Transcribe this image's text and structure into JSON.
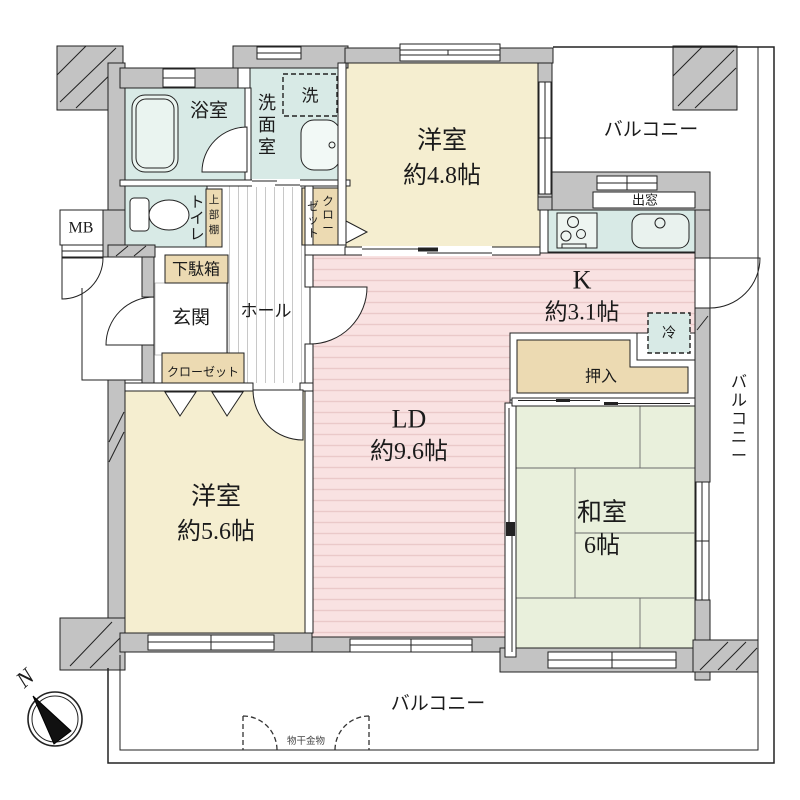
{
  "plan": {
    "compass": {
      "north": "N"
    },
    "balconies": {
      "top": "バルコニー",
      "right": "バルコニー",
      "bottom": "バルコニー",
      "laundry_fitting": "物干金物"
    },
    "rooms": {
      "western1": {
        "name": "洋室",
        "area": "約4.8帖"
      },
      "western2": {
        "name": "洋室",
        "area": "約5.6帖"
      },
      "living_dining": {
        "name": "LD",
        "area": "約9.6帖"
      },
      "kitchen": {
        "name": "K",
        "area": "約3.1帖"
      },
      "japanese": {
        "name": "和室",
        "area": "6帖"
      },
      "bath": {
        "name": "浴室"
      },
      "washroom": {
        "name": "洗面室"
      },
      "toilet": {
        "name": "トイレ"
      },
      "entrance": {
        "name": "玄関"
      },
      "hall": {
        "name": "ホール"
      }
    },
    "storage": {
      "shoe_cabinet": "下駄箱",
      "closet_lower": "クローゼット",
      "closet_upper_col_right": "クロー",
      "closet_upper_col_left": "ゼット",
      "upper_shelf": "上部棚",
      "oshiire": "押入"
    },
    "fixtures": {
      "washer": "洗",
      "fridge": "冷",
      "bay_window": "出窓",
      "meter_box": "MB"
    },
    "palette": {
      "wall_gray": "#c3c3c3",
      "wet_area_teal": "#d8eae6",
      "western_room_cream": "#f5eed0",
      "ldk_pink": "#f9e2e2",
      "ldk_stripe": "#eac9c9",
      "tatami_green": "#e9f0dc",
      "storage_tan": "#ecdab2"
    }
  }
}
